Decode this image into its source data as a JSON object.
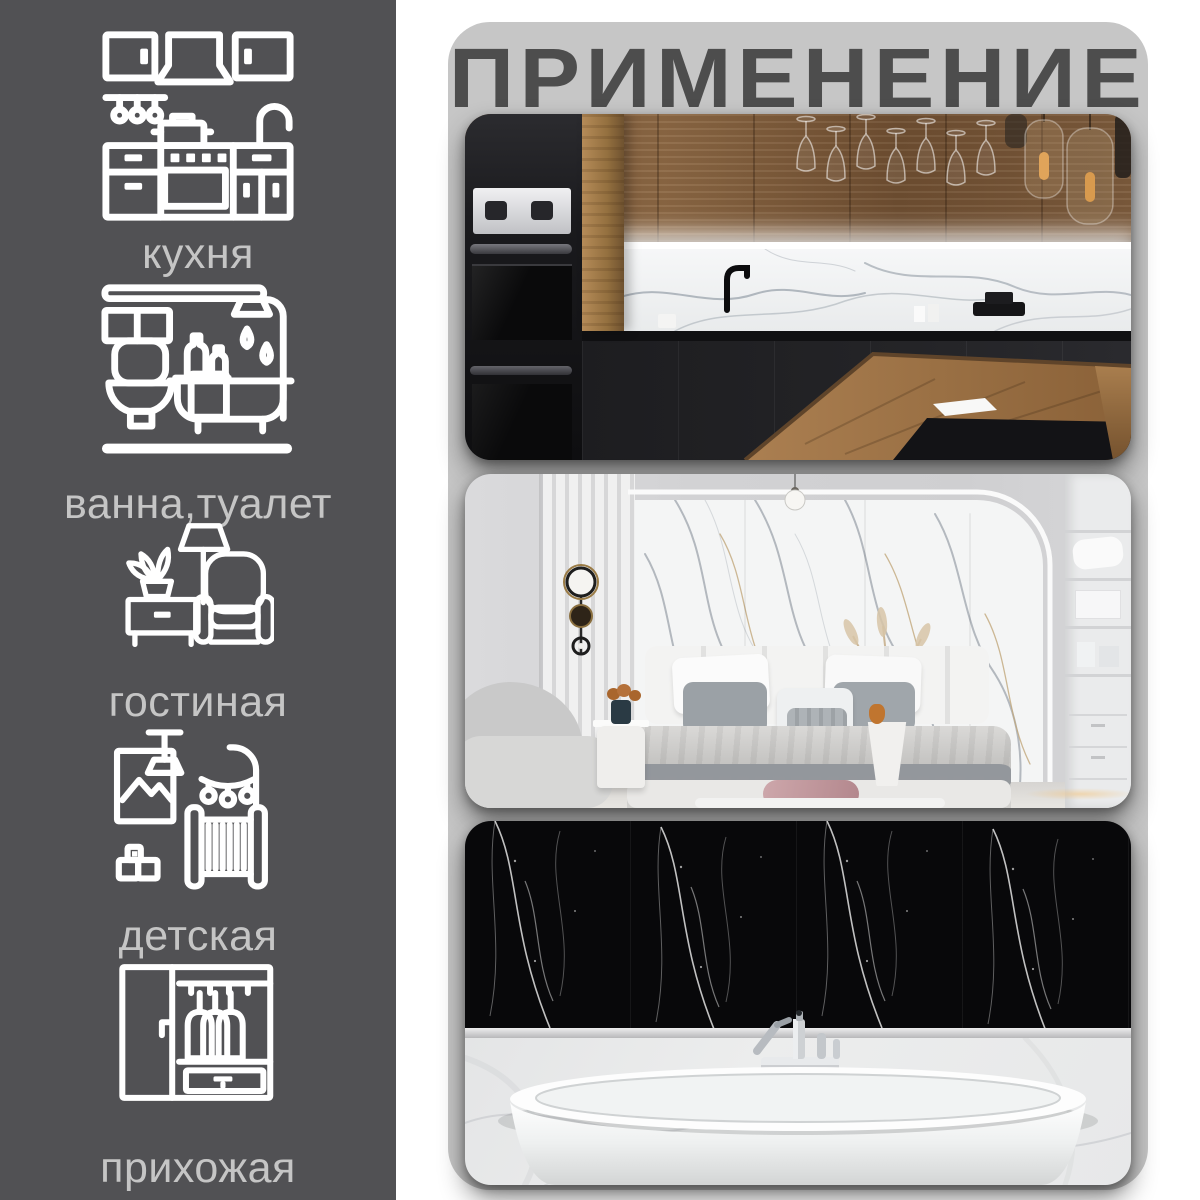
{
  "title": "ПРИМЕНЕНИЕ",
  "theme": {
    "page-bg": "#ffffff",
    "sidebar-bg": "#515154",
    "panel-bg": "#c6c6c6",
    "title-color": "#4d4d4d",
    "label-color": "#c5c5c5",
    "icon-color": "#ffffff"
  },
  "sidebar": {
    "items": [
      {
        "icon": "kitchen-icon",
        "label": "кухня"
      },
      {
        "icon": "bathroom-icon",
        "label": "ванна,туалет"
      },
      {
        "icon": "living-room-icon",
        "label": "гостиная"
      },
      {
        "icon": "nursery-icon",
        "label": "детская"
      },
      {
        "icon": "hallway-icon",
        "label": "прихожая"
      }
    ]
  },
  "gallery": {
    "photos": [
      {
        "name": "kitchen-photo"
      },
      {
        "name": "bedroom-photo"
      },
      {
        "name": "bathroom-photo"
      }
    ]
  }
}
